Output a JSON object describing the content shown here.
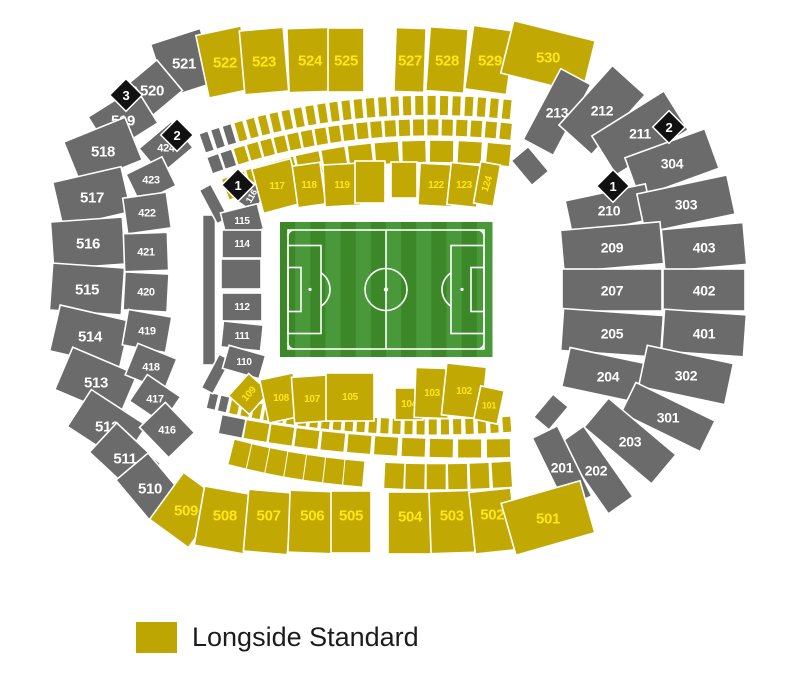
{
  "legend": {
    "label": "Longside Standard",
    "swatch_color": "#bea602"
  },
  "colors": {
    "std": "#c2a803",
    "std_text": "#ffe713",
    "na": "#6b6b6b",
    "na_text": "#ffffff",
    "diamond": "#111111",
    "diamond_text": "#ffffff",
    "gap": "#ffffff"
  },
  "map": {
    "sections": [
      {
        "id": "521",
        "cat": "na",
        "x": 184,
        "y": 63,
        "w": 52,
        "h": 56,
        "rot": -18,
        "fs": 15
      },
      {
        "id": "520",
        "cat": "na",
        "x": 152,
        "y": 90,
        "w": 46,
        "h": 40,
        "rot": -40,
        "fs": 15
      },
      {
        "id": "519",
        "cat": "na",
        "x": 123,
        "y": 120,
        "w": 56,
        "h": 42,
        "rot": -32,
        "fs": 15
      },
      {
        "id": "518",
        "cat": "na",
        "x": 103,
        "y": 151,
        "w": 66,
        "h": 46,
        "rot": -22,
        "fs": 15
      },
      {
        "id": "517",
        "cat": "na",
        "x": 92,
        "y": 197,
        "w": 70,
        "h": 46,
        "rot": -13,
        "fs": 15
      },
      {
        "id": "516",
        "cat": "na",
        "x": 88,
        "y": 243,
        "w": 72,
        "h": 47,
        "rot": -4,
        "fs": 15
      },
      {
        "id": "515",
        "cat": "na",
        "x": 87,
        "y": 289,
        "w": 72,
        "h": 47,
        "rot": 4,
        "fs": 15
      },
      {
        "id": "514",
        "cat": "na",
        "x": 90,
        "y": 336,
        "w": 72,
        "h": 47,
        "rot": 13,
        "fs": 15
      },
      {
        "id": "513",
        "cat": "na",
        "x": 96,
        "y": 382,
        "w": 70,
        "h": 46,
        "rot": 23,
        "fs": 15
      },
      {
        "id": "512",
        "cat": "na",
        "x": 107,
        "y": 426,
        "w": 66,
        "h": 44,
        "rot": 33,
        "fs": 15
      },
      {
        "id": "511",
        "cat": "na",
        "x": 125,
        "y": 458,
        "w": 60,
        "h": 40,
        "rot": 43,
        "fs": 15
      },
      {
        "id": "510",
        "cat": "na",
        "x": 150,
        "y": 488,
        "w": 56,
        "h": 42,
        "rot": 50,
        "fs": 15
      },
      {
        "id": "522",
        "cat": "std",
        "x": 225,
        "y": 62,
        "w": 46,
        "h": 64,
        "rot": -12,
        "fs": 15
      },
      {
        "id": "523",
        "cat": "std",
        "x": 264,
        "y": 61,
        "w": 44,
        "h": 64,
        "rot": -5,
        "fs": 15
      },
      {
        "id": "524",
        "cat": "std",
        "x": 310,
        "y": 60,
        "w": 44,
        "h": 64,
        "rot": -2,
        "fs": 15
      },
      {
        "id": "525",
        "cat": "std",
        "x": 346,
        "y": 60,
        "w": 36,
        "h": 64,
        "rot": 0,
        "fs": 15
      },
      {
        "id": "527",
        "cat": "std",
        "x": 410,
        "y": 60,
        "w": 30,
        "h": 64,
        "rot": 2,
        "fs": 15
      },
      {
        "id": "528",
        "cat": "std",
        "x": 447,
        "y": 60,
        "w": 38,
        "h": 64,
        "rot": 4,
        "fs": 15
      },
      {
        "id": "529",
        "cat": "std",
        "x": 490,
        "y": 60,
        "w": 42,
        "h": 64,
        "rot": 8,
        "fs": 15
      },
      {
        "id": "530",
        "cat": "std",
        "x": 548,
        "y": 57,
        "w": 84,
        "h": 54,
        "rot": 14,
        "fs": 15
      },
      {
        "id": "213",
        "cat": "na",
        "x": 557,
        "y": 112,
        "w": 80,
        "h": 34,
        "rot": -62,
        "fs": 14
      },
      {
        "id": "212",
        "cat": "na",
        "x": 602,
        "y": 110,
        "w": 80,
        "h": 44,
        "rot": -48,
        "fs": 14
      },
      {
        "id": "211",
        "cat": "na",
        "x": 640,
        "y": 133,
        "w": 85,
        "h": 46,
        "rot": -32,
        "fs": 14
      },
      {
        "id": "304",
        "cat": "na",
        "x": 672,
        "y": 163,
        "w": 85,
        "h": 42,
        "rot": -20,
        "fs": 14
      },
      {
        "id": "210",
        "cat": "na",
        "x": 609,
        "y": 210,
        "w": 82,
        "h": 36,
        "rot": -12,
        "fs": 14
      },
      {
        "id": "303",
        "cat": "na",
        "x": 686,
        "y": 204,
        "w": 92,
        "h": 40,
        "rot": -12,
        "fs": 14
      },
      {
        "id": "209",
        "cat": "na",
        "x": 612,
        "y": 247,
        "w": 100,
        "h": 42,
        "rot": -5,
        "fs": 14
      },
      {
        "id": "403",
        "cat": "na",
        "x": 704,
        "y": 247,
        "w": 82,
        "h": 42,
        "rot": -5,
        "fs": 14
      },
      {
        "id": "207",
        "cat": "na",
        "x": 612,
        "y": 290,
        "w": 100,
        "h": 42,
        "rot": 0,
        "fs": 14
      },
      {
        "id": "402",
        "cat": "na",
        "x": 704,
        "y": 290,
        "w": 82,
        "h": 42,
        "rot": 0,
        "fs": 14
      },
      {
        "id": "205",
        "cat": "na",
        "x": 612,
        "y": 333,
        "w": 100,
        "h": 42,
        "rot": 4,
        "fs": 14
      },
      {
        "id": "401",
        "cat": "na",
        "x": 704,
        "y": 333,
        "w": 82,
        "h": 42,
        "rot": 4,
        "fs": 14
      },
      {
        "id": "204",
        "cat": "na",
        "x": 608,
        "y": 376,
        "w": 86,
        "h": 40,
        "rot": 12,
        "fs": 14
      },
      {
        "id": "302",
        "cat": "na",
        "x": 686,
        "y": 375,
        "w": 88,
        "h": 42,
        "rot": 12,
        "fs": 14
      },
      {
        "id": "301",
        "cat": "na",
        "x": 668,
        "y": 417,
        "w": 88,
        "h": 34,
        "rot": 26,
        "fs": 14
      },
      {
        "id": "203",
        "cat": "na",
        "x": 630,
        "y": 441,
        "w": 88,
        "h": 38,
        "rot": 40,
        "fs": 14
      },
      {
        "id": "202",
        "cat": "na",
        "x": 596,
        "y": 470,
        "w": 86,
        "h": 30,
        "rot": 55,
        "fs": 14
      },
      {
        "id": "201",
        "cat": "na",
        "x": 562,
        "y": 467,
        "w": 78,
        "h": 28,
        "rot": 64,
        "fs": 14
      },
      {
        "id": "509",
        "cat": "std",
        "x": 186,
        "y": 510,
        "w": 48,
        "h": 58,
        "rot": 36,
        "fs": 15
      },
      {
        "id": "508",
        "cat": "std",
        "x": 224,
        "y": 520,
        "w": 50,
        "h": 60,
        "rot": 10,
        "ly": -5,
        "fs": 15
      },
      {
        "id": "507",
        "cat": "std",
        "x": 268,
        "y": 522,
        "w": 44,
        "h": 62,
        "rot": 5,
        "ly": -7,
        "fs": 15
      },
      {
        "id": "506",
        "cat": "std",
        "x": 312,
        "y": 522,
        "w": 46,
        "h": 62,
        "rot": 2,
        "ly": -7,
        "fs": 15
      },
      {
        "id": "505",
        "cat": "std",
        "x": 351,
        "y": 522,
        "w": 40,
        "h": 62,
        "rot": 0,
        "ly": -7,
        "fs": 15
      },
      {
        "id": "504",
        "cat": "std",
        "x": 410,
        "y": 523,
        "w": 44,
        "h": 62,
        "rot": 0,
        "ly": -7,
        "fs": 15
      },
      {
        "id": "503",
        "cat": "std",
        "x": 452,
        "y": 522,
        "w": 44,
        "h": 62,
        "rot": -2,
        "ly": -7,
        "fs": 15
      },
      {
        "id": "502",
        "cat": "std",
        "x": 493,
        "y": 521,
        "w": 42,
        "h": 62,
        "rot": -6,
        "ly": -7,
        "fs": 15
      },
      {
        "id": "501",
        "cat": "std",
        "x": 548,
        "y": 518,
        "w": 82,
        "h": 54,
        "rot": -16,
        "fs": 15
      },
      {
        "id": "424",
        "cat": "na",
        "x": 166,
        "y": 148,
        "w": 42,
        "h": 34,
        "rot": -40,
        "fs": 11
      },
      {
        "id": "423",
        "cat": "na",
        "x": 151,
        "y": 180,
        "w": 40,
        "h": 32,
        "rot": -26,
        "fs": 11
      },
      {
        "id": "422",
        "cat": "na",
        "x": 147,
        "y": 213,
        "w": 44,
        "h": 36,
        "rot": -8,
        "fs": 11
      },
      {
        "id": "421",
        "cat": "na",
        "x": 146,
        "y": 252,
        "w": 44,
        "h": 38,
        "rot": -2,
        "fs": 11
      },
      {
        "id": "420",
        "cat": "na",
        "x": 146,
        "y": 292,
        "w": 44,
        "h": 38,
        "rot": 3,
        "fs": 11
      },
      {
        "id": "419",
        "cat": "na",
        "x": 147,
        "y": 331,
        "w": 44,
        "h": 36,
        "rot": 10,
        "fs": 11
      },
      {
        "id": "418",
        "cat": "na",
        "x": 151,
        "y": 367,
        "w": 42,
        "h": 34,
        "rot": 22,
        "fs": 11
      },
      {
        "id": "417",
        "cat": "na",
        "x": 155,
        "y": 399,
        "w": 40,
        "h": 32,
        "rot": 34,
        "fs": 11
      },
      {
        "id": "416",
        "cat": "na",
        "x": 167,
        "y": 430,
        "w": 42,
        "h": 36,
        "rot": 46,
        "fs": 11
      },
      {
        "id": "",
        "cat": "na",
        "x": 209,
        "y": 290,
        "w": 13,
        "h": 150,
        "rot": 0
      },
      {
        "id": "",
        "cat": "na",
        "x": 214,
        "y": 204,
        "w": 13,
        "h": 38,
        "rot": -28
      },
      {
        "id": "",
        "cat": "na",
        "x": 216,
        "y": 374,
        "w": 13,
        "h": 38,
        "rot": 28
      },
      {
        "id": "",
        "cat": "na",
        "x": 530,
        "y": 166,
        "w": 22,
        "h": 32,
        "rot": -40
      },
      {
        "id": "",
        "cat": "na",
        "x": 551,
        "y": 412,
        "w": 20,
        "h": 30,
        "rot": 40
      },
      {
        "id": "116",
        "cat": "na",
        "x": 251,
        "y": 196,
        "w": 24,
        "h": 22,
        "rot": -55,
        "lr": -60,
        "fs": 9
      },
      {
        "id": "115",
        "cat": "na",
        "x": 242,
        "y": 221,
        "w": 38,
        "h": 26,
        "rot": -14,
        "fs": 10
      },
      {
        "id": "114",
        "cat": "na",
        "x": 242,
        "y": 244,
        "w": 40,
        "h": 28,
        "rot": 0,
        "fs": 10
      },
      {
        "id": "",
        "cat": "na",
        "x": 241,
        "y": 274,
        "w": 40,
        "h": 30,
        "rot": 0
      },
      {
        "id": "112",
        "cat": "na",
        "x": 242,
        "y": 307,
        "w": 40,
        "h": 28,
        "rot": 0,
        "fs": 10
      },
      {
        "id": "111",
        "cat": "na",
        "x": 242,
        "y": 336,
        "w": 40,
        "h": 26,
        "rot": 6,
        "fs": 10
      },
      {
        "id": "110",
        "cat": "na",
        "x": 244,
        "y": 362,
        "w": 38,
        "h": 24,
        "rot": 16,
        "fs": 10
      },
      {
        "id": "117",
        "cat": "std",
        "x": 277,
        "y": 186,
        "w": 40,
        "h": 46,
        "rot": -15,
        "fs": 10
      },
      {
        "id": "118",
        "cat": "std",
        "x": 309,
        "y": 185,
        "w": 28,
        "h": 42,
        "rot": -8,
        "fs": 10
      },
      {
        "id": "119",
        "cat": "std",
        "x": 342,
        "y": 185,
        "w": 36,
        "h": 42,
        "rot": -3,
        "fs": 10
      },
      {
        "id": "",
        "cat": "std",
        "x": 370,
        "y": 182,
        "w": 30,
        "h": 42,
        "rot": 0
      },
      {
        "id": "",
        "cat": "std",
        "x": 404,
        "y": 180,
        "w": 26,
        "h": 36,
        "rot": 0
      },
      {
        "id": "122",
        "cat": "std",
        "x": 436,
        "y": 185,
        "w": 34,
        "h": 42,
        "rot": 3,
        "fs": 10
      },
      {
        "id": "123",
        "cat": "std",
        "x": 464,
        "y": 185,
        "w": 30,
        "h": 42,
        "rot": 6,
        "fs": 10
      },
      {
        "id": "124",
        "cat": "std",
        "x": 487,
        "y": 184,
        "w": 20,
        "h": 42,
        "rot": 10,
        "lr": -72,
        "fs": 10
      },
      {
        "id": "109",
        "cat": "std",
        "x": 249,
        "y": 394,
        "w": 28,
        "h": 30,
        "rot": 42,
        "lr": -48,
        "fs": 10
      },
      {
        "id": "108",
        "cat": "std",
        "x": 281,
        "y": 398,
        "w": 34,
        "h": 44,
        "rot": -12,
        "fs": 10
      },
      {
        "id": "107",
        "cat": "std",
        "x": 312,
        "y": 399,
        "w": 38,
        "h": 46,
        "rot": -4,
        "fs": 10
      },
      {
        "id": "105",
        "cat": "std",
        "x": 350,
        "y": 397,
        "w": 48,
        "h": 48,
        "rot": 0,
        "fs": 10
      },
      {
        "id": "104",
        "cat": "std",
        "x": 409,
        "y": 404,
        "w": 28,
        "h": 32,
        "rot": 0,
        "fs": 10
      },
      {
        "id": "103",
        "cat": "std",
        "x": 432,
        "y": 393,
        "w": 34,
        "h": 50,
        "rot": 2,
        "fs": 10
      },
      {
        "id": "102",
        "cat": "std",
        "x": 464,
        "y": 391,
        "w": 40,
        "h": 52,
        "rot": 6,
        "fs": 10
      },
      {
        "id": "101",
        "cat": "std",
        "x": 489,
        "y": 405,
        "w": 24,
        "h": 34,
        "rot": 12,
        "fs": 9
      }
    ],
    "rows": [
      {
        "n": 26,
        "bw": 9,
        "bh": 20,
        "gray": 3,
        "s": [
          201,
          144
        ],
        "c": [
          348,
          92
        ],
        "e": [
          513,
          110
        ]
      },
      {
        "n": 22,
        "bw": 12,
        "bh": 17,
        "gray": 2,
        "s": [
          209,
          166
        ],
        "c": [
          350,
          114
        ],
        "e": [
          513,
          132
        ]
      },
      {
        "n": 11,
        "bw": 24,
        "bh": 22,
        "gray": 0,
        "s": [
          225,
          190
        ],
        "c": [
          352,
          138
        ],
        "e": [
          513,
          156
        ]
      },
      {
        "n": 26,
        "bw": 9,
        "bh": 16,
        "gray": 2,
        "s": [
          207,
          400
        ],
        "c": [
          350,
          436
        ],
        "e": [
          513,
          424
        ]
      },
      {
        "n": 11,
        "bw": 24,
        "bh": 19,
        "gray": 1,
        "s": [
          220,
          424
        ],
        "c": [
          352,
          452
        ],
        "e": [
          513,
          448
        ]
      },
      {
        "n": 14,
        "bw": 20,
        "bh": 26,
        "gray": 0,
        "skip": [
          7
        ],
        "s": [
          232,
          452
        ],
        "c": [
          355,
          485
        ],
        "e": [
          513,
          474
        ]
      }
    ],
    "diamonds": [
      {
        "n": "3",
        "x": 126,
        "y": 95
      },
      {
        "n": "2",
        "x": 177,
        "y": 135
      },
      {
        "n": "1",
        "x": 238,
        "y": 185
      },
      {
        "n": "2",
        "x": 669,
        "y": 127
      },
      {
        "n": "1",
        "x": 613,
        "y": 186
      }
    ],
    "pitch": {
      "x": 280,
      "y": 222,
      "w": 212,
      "h": 135,
      "stripe_dark": "#3c8829",
      "stripe_light": "#49993a",
      "line_color": "#ffffff"
    }
  }
}
